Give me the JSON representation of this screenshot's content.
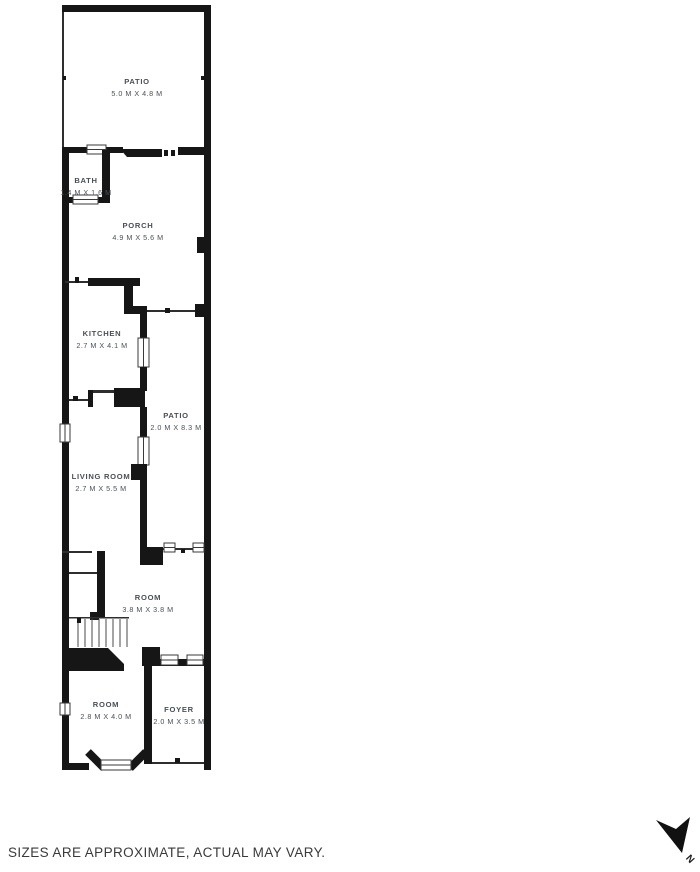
{
  "plan": {
    "rooms": [
      {
        "name": "PATIO",
        "dims": "5.0 M X 4.8 M"
      },
      {
        "name": "BATH",
        "dims": "1.4 M X 1.6 M"
      },
      {
        "name": "PORCH",
        "dims": "4.9 M X 5.6 M"
      },
      {
        "name": "KITCHEN",
        "dims": "2.7 M X 4.1 M"
      },
      {
        "name": "PATIO",
        "dims": "2.0 M X 8.3 M"
      },
      {
        "name": "LIVING ROOM",
        "dims": "2.7 M X 5.5 M"
      },
      {
        "name": "ROOM",
        "dims": "3.8 M X 3.8 M"
      },
      {
        "name": "ROOM",
        "dims": "2.8 M X 4.0 M"
      },
      {
        "name": "FOYER",
        "dims": "2.0 M X 3.5 M"
      }
    ],
    "colors": {
      "wall": "#161616",
      "label": "#4a4f57",
      "background": "#ffffff"
    }
  },
  "footer": {
    "disclaimer": "SIZES ARE APPROXIMATE, ACTUAL MAY VARY."
  },
  "compass": {
    "label": "N"
  }
}
